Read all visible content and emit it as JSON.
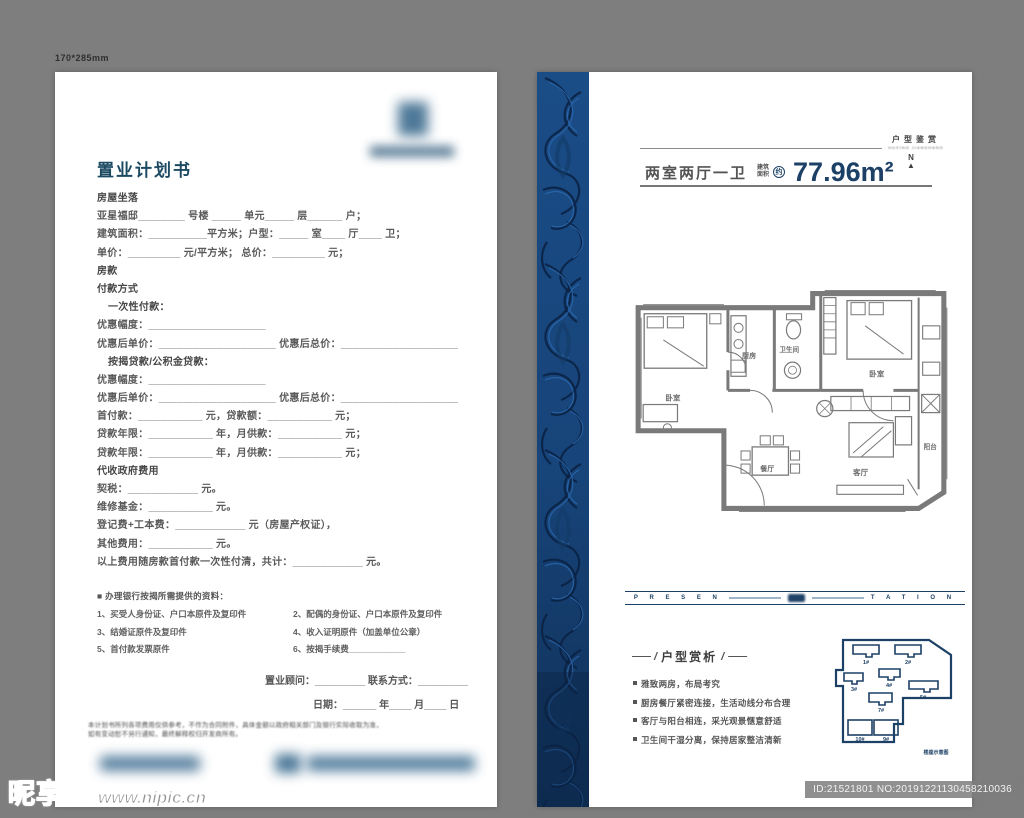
{
  "meta": {
    "size_label": "170*285mm"
  },
  "colors": {
    "navy": "#1d4066",
    "title_blue": "#1c4a63",
    "strip_blue": "#17477e",
    "plan_gray": "#7a7a7a",
    "background": "#7e7e7e"
  },
  "watermark": {
    "site": "昵享网",
    "url": "www.nipic.cn",
    "id": "ID:21521801 NO:20191221130458210036"
  },
  "left_page": {
    "title": "置业计划书",
    "form_lines": [
      {
        "t": "房屋坐落",
        "c": "hd"
      },
      {
        "t": "亚星福邸________ 号楼 _____ 单元_____ 层______ 户；",
        "c": ""
      },
      {
        "t": "建筑面积：__________平方米；户型：_____ 室____ 厅____ 卫；",
        "c": ""
      },
      {
        "t": "单价：_________ 元/平方米；  总价：_________ 元；",
        "c": ""
      },
      {
        "t": "房款",
        "c": "hd"
      },
      {
        "t": "付款方式",
        "c": "hd"
      },
      {
        "t": "一次性付款：",
        "c": "ind"
      },
      {
        "t": "优惠幅度：____________________",
        "c": ""
      },
      {
        "t": "优惠后单价：____________________  优惠后总价：____________________",
        "c": ""
      },
      {
        "t": "按揭贷款/公积金贷款：",
        "c": "ind"
      },
      {
        "t": "优惠幅度：____________________",
        "c": ""
      },
      {
        "t": "优惠后单价：____________________  优惠后总价：____________________",
        "c": ""
      },
      {
        "t": "首付款：___________ 元，贷款额：___________ 元；",
        "c": ""
      },
      {
        "t": "贷款年限：___________ 年，月供款：___________ 元；",
        "c": ""
      },
      {
        "t": "贷款年限：___________ 年，月供款：___________ 元；",
        "c": ""
      },
      {
        "t": "代收政府费用",
        "c": "hd"
      },
      {
        "t": "契税：____________ 元。",
        "c": ""
      },
      {
        "t": "维修基金：___________ 元。",
        "c": ""
      },
      {
        "t": "登记费+工本费：____________ 元（房屋产权证），",
        "c": ""
      },
      {
        "t": "其他费用：___________ 元。",
        "c": ""
      },
      {
        "t": "以上费用随房款首付款一次性付清，共计：____________ 元。",
        "c": ""
      }
    ],
    "docs_title": "■ 办理银行按揭所需提供的资料：",
    "docs": [
      "1、买受人身份证、户口本原件及复印件",
      "2、配偶的身份证、户口本原件及复印件",
      "3、结婚证原件及复印件",
      "4、收入证明原件（加盖单位公章）",
      "5、首付款发票原件",
      "6、按揭手续费____________"
    ],
    "consultant_line": "置业顾问：_________  联系方式：_________",
    "date_line": "日期：______ 年____ 月____ 日",
    "disclaimer1": "本计划书所列各项费用仅供参考，不作为合同附件，具体金额以政府相关部门及银行实际收取为准，",
    "disclaimer2": "如有变动恕不另行通知，最终解释权归开发商所有。"
  },
  "right_page": {
    "corner_title": "户型鉴赏",
    "corner_sub": "HUXING JIANSHANG",
    "layout_text": "两室两厅一卫",
    "area_label_top": "建筑",
    "area_label_bottom": "面积",
    "area_approx": "约",
    "area_value": "77.96m²",
    "compass_n": "N",
    "compass_arrow": "▲",
    "floorplan_rooms": {
      "bedroom_left": "卧室",
      "kitchen": "厨房",
      "bath": "卫生间",
      "bedroom_right": "卧室",
      "dining": "餐厅",
      "living": "客厅",
      "balcony": "阳台"
    },
    "band_left": "P R E S E N",
    "band_right": "T A T I O N",
    "analysis_dash": "——",
    "analysis_slash": "/",
    "analysis_title": "户型赏析",
    "bullets": [
      "雅致两房，布局考究",
      "厨房餐厅紧密连接，生活动线分布合理",
      "客厅与阳台相连，采光观景惬意舒适",
      "卫生间干湿分离，保持居家整洁清新"
    ],
    "keyplan_units": [
      "1#",
      "2#",
      "3#",
      "4#",
      "5#",
      "7#",
      "10#",
      "9#"
    ],
    "keyplan_caption": "楼座示意图"
  }
}
